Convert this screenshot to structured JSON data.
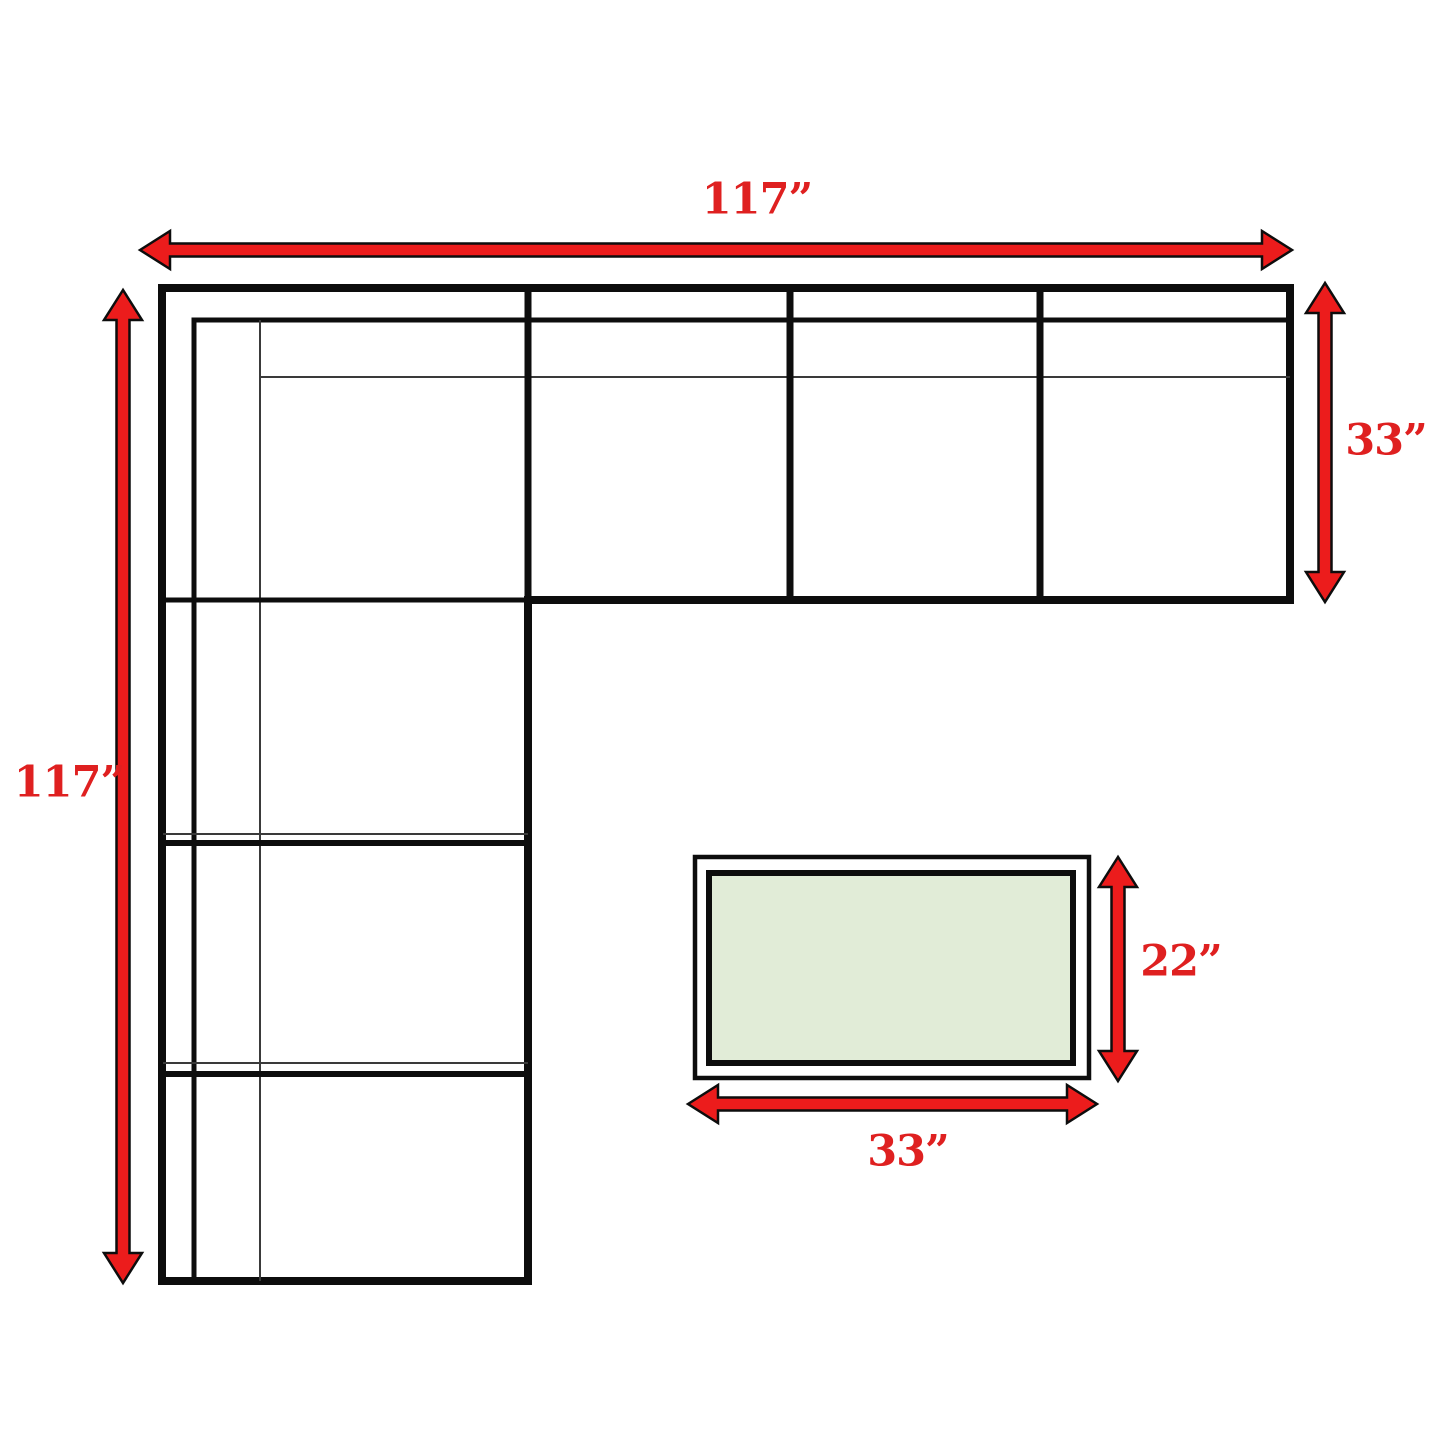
{
  "diagram": {
    "type": "furniture-dimension-diagram",
    "subject": "L-shaped sectional sofa with ottoman, top view with dimension arrows",
    "colors": {
      "background": "#ffffff",
      "line": "#0d0d0d",
      "thin_line": "#3a3a3a",
      "arrow_fill": "#ec1c1c",
      "label_text": "#df2020",
      "ottoman_fill": "#e1ecd7"
    },
    "labels": {
      "sofa_width": "117”",
      "sofa_depth": "117”",
      "section_depth": "33”",
      "ottoman_depth": "22”",
      "ottoman_width": "33”"
    }
  }
}
